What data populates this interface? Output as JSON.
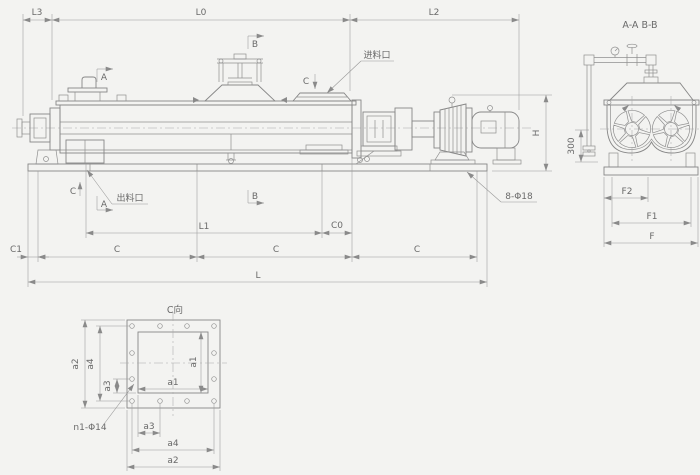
{
  "colors": {
    "background": "#f3f3f1",
    "line": "#878787",
    "text": "#6a6a6a"
  },
  "front": {
    "dims": {
      "l3": "L3",
      "l0": "L0",
      "l2": "L2",
      "h": "H",
      "l1": "L1",
      "c0": "C0",
      "c1": "C1",
      "c_left": "C",
      "c_mid": "C",
      "c_right": "C",
      "l": "L"
    },
    "markers": {
      "a_top": "A",
      "b_top": "B",
      "c_top": "C",
      "a_bot": "A",
      "b_bot": "B",
      "c_bot": "C"
    },
    "callouts": {
      "feed": "进料口",
      "discharge": "出料口",
      "base_holes": "8-Φ18"
    }
  },
  "section": {
    "title": "A-A B-B",
    "dims": {
      "h300": "300",
      "f2": "F2",
      "f1": "F1",
      "f": "F"
    }
  },
  "cview": {
    "title": "C向",
    "dims": {
      "a1h": "a1",
      "a1v": "a1",
      "a2v": "a2",
      "a2h": "a2",
      "a3v": "a3",
      "a3h": "a3",
      "a4v": "a4",
      "a4h": "a4"
    },
    "callout_holes": "n1-Φ14"
  }
}
